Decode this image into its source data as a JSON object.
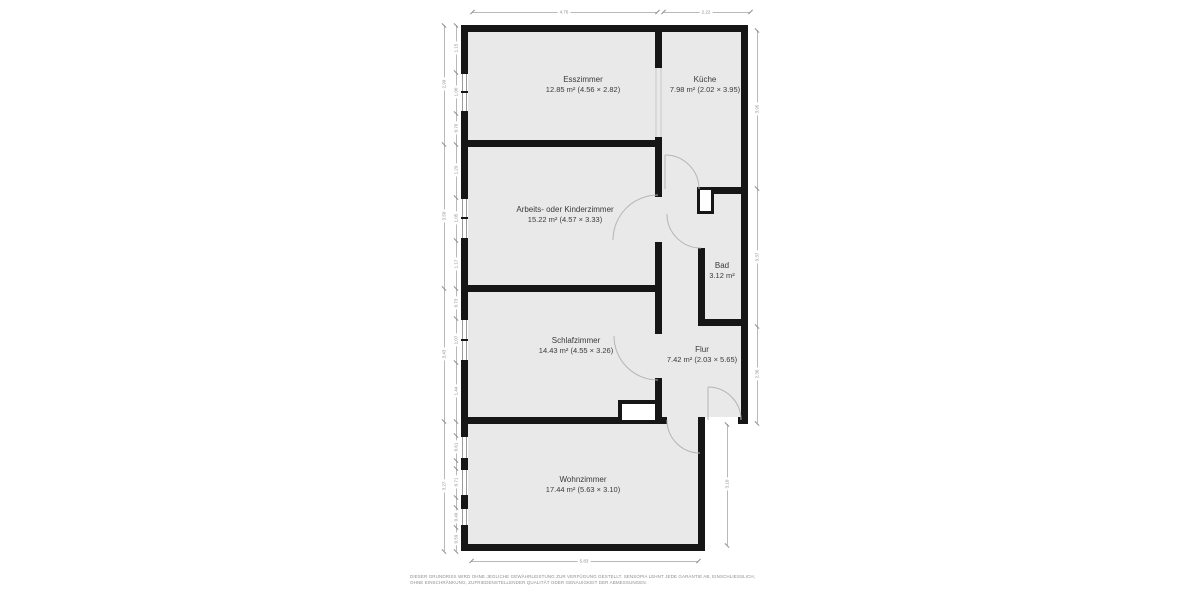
{
  "plan_title": "Grundriss",
  "rooms": {
    "esszimmer": {
      "name": "Esszimmer",
      "details": "12.85 m² (4.56 × 2.82)"
    },
    "kueche": {
      "name": "Küche",
      "details": "7.98 m² (2.02 × 3.95)"
    },
    "arbeitszimmer": {
      "name": "Arbeits- oder Kinderzimmer",
      "details": "15.22 m² (4.57 × 3.33)"
    },
    "bad": {
      "name": "Bad",
      "details": "3.12 m²"
    },
    "schlafzimmer": {
      "name": "Schlafzimmer",
      "details": "14.43 m² (4.55 × 3.26)"
    },
    "flur": {
      "name": "Flur",
      "details": "7.42 m² (2.03 × 5.65)"
    },
    "wohnzimmer": {
      "name": "Wohnzimmer",
      "details": "17.44 m² (5.63 × 3.10)"
    }
  },
  "dimensions": {
    "top": [
      "4.76",
      "2.22"
    ],
    "bottom": [
      "5.83"
    ],
    "left_outer": [
      "2.99",
      "3.50",
      "3.43",
      "3.27"
    ],
    "left_inner": [
      "1.15",
      "1.00",
      "0.76",
      "1.29",
      "1.05",
      "1.17",
      "0.73",
      "1.07",
      "1.44",
      "0.61",
      "0.71",
      "0.49",
      "0.59"
    ],
    "right_outer": [
      "3.95",
      "3.37",
      "2.36"
    ],
    "right_inner": [
      "3.10"
    ]
  },
  "disclaimer": "DIESER GRUNDRISS WIRD OHNE JEGLICHE GEWÄHRLEISTUNG ZUR VERFÜGUNG GESTELLT. SENSOPIA LEHNT JEDE GARANTIE AB, EINSCHLIESSLICH, OHNE EINSCHRÄNKUNG, ZUFRIEDENSTELLENDER QUALITÄT ODER GENAUIGKEIT DER ABMESSUNGEN.",
  "colors": {
    "wall": "#161616",
    "floor": "#e9e9e9",
    "dimension": "#8f8f8f",
    "label": "#3a3a3a",
    "door_arc": "#b5b5b5"
  }
}
